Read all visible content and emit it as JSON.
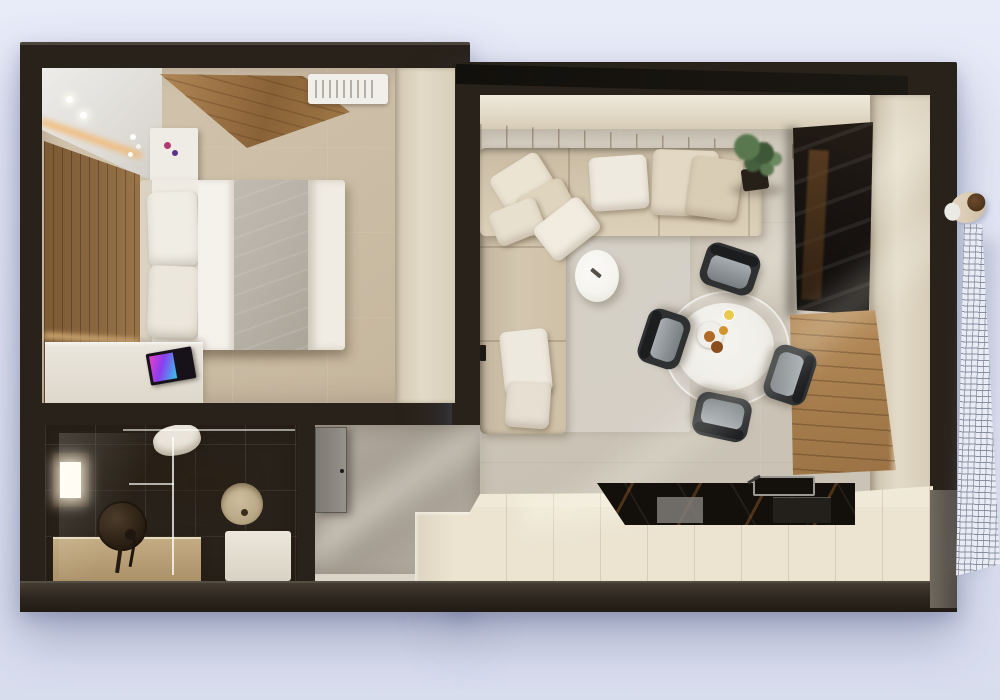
{
  "scene": {
    "type": "3d-floorplan-top-view-render",
    "description": "Photorealistic top-down 3D render of a studio apartment with dark walls on a light lavender background",
    "text_labels": []
  },
  "colors": {
    "bg_top": "#e8ebf8",
    "bg_bottom": "#d8ddee",
    "wall": "#29221a",
    "wall_overhang": "#12100c",
    "wall_bottom_face": "#453c31",
    "wall_lower_right": "#6e685e",
    "cream_wall": "#e3dac7",
    "cream_wall_dark": "#d2c8b2",
    "bedroom_floor": "#d2c4ad",
    "wood_light": "#b08a58",
    "wood_dark": "#7c5a34",
    "bed_white": "#efebe2",
    "bed_sheet": "#f5f2ec",
    "blanket_grey": "#b8b2a8",
    "pillow_white": "#f0ede5",
    "desk_white": "#ebe7de",
    "magazine_pink": "#e83ec8",
    "magazine_blue": "#35c8e8",
    "magazine_black": "#17121a",
    "sofa": "#d4c7af",
    "sofa_dark": "#c2b49c",
    "rug": "#d6d1c8",
    "living_floor": "#cfc8ba",
    "coffee_table": "#f6f4ef",
    "plant_green": "#5a7850",
    "plant_dark": "#3e5736",
    "pot": "#262018",
    "wardrobe": "#191411",
    "chair_dark": "#2e3032",
    "chair_seat": "#a8aeb2",
    "table_white": "#f0eee8",
    "counter_black": "#130f0b",
    "counter_streak": "#96602c",
    "kitchen_cream": "#ece4d1",
    "bath_tile": "#8a7151",
    "bath_tile_dark": "#5f4b31",
    "bath_vanity": "#c3ab83",
    "window_glow": "#fffdf2",
    "hall_floor": "#b3ab9f",
    "door_grey": "#8b8780",
    "railing_base": "#e9ecf4",
    "railing_grid": "#8e96a8",
    "skin_beige": "#dcccb5",
    "hair_brown": "#53371f",
    "glow_warm": "#f2b873"
  },
  "rooms": {
    "bedroom": {
      "position": "top-left",
      "furniture": [
        "double-bed",
        "two-white-pillows",
        "grey-runner-blanket",
        "nightstand-with-orchid",
        "wood-slat-accent-wall-with-led-glow",
        "slanted-wood-ceiling-panel",
        "ac-vent-grille",
        "vanity-desk",
        "colorful-magazine",
        "two-ceiling-spotlights"
      ]
    },
    "bathroom": {
      "position": "bottom-left",
      "furniture": [
        "glowing-window",
        "round-dark-mirror",
        "vanity-counter",
        "glass-shower-partition",
        "shower-head",
        "toilet",
        "round-basin",
        "white-unit"
      ]
    },
    "hallway": {
      "position": "bottom-center-left",
      "furniture": [
        "entry-door-grey",
        "door-handle",
        "baseboard"
      ]
    },
    "living_kitchen": {
      "position": "right",
      "furniture": [
        "l-shaped-corner-sofa",
        "nine-cushions",
        "grey-rug",
        "oval-white-coffee-table",
        "remote",
        "round-glass-dining-table",
        "plate-with-pastries",
        "drink-glass",
        "potted-plant",
        "dark-gloss-wardrobe",
        "wooden-table-panel",
        "kitchen-counter-run",
        "black-stone-countertop",
        "sink-with-faucet",
        "dishwasher-front",
        "oven-front",
        "wood-strip-floor-border"
      ],
      "dining_chairs_count": 4
    },
    "balcony": {
      "position": "right-edge",
      "furniture": [
        "grid-railing",
        "person-leaning-over-railing"
      ]
    }
  }
}
